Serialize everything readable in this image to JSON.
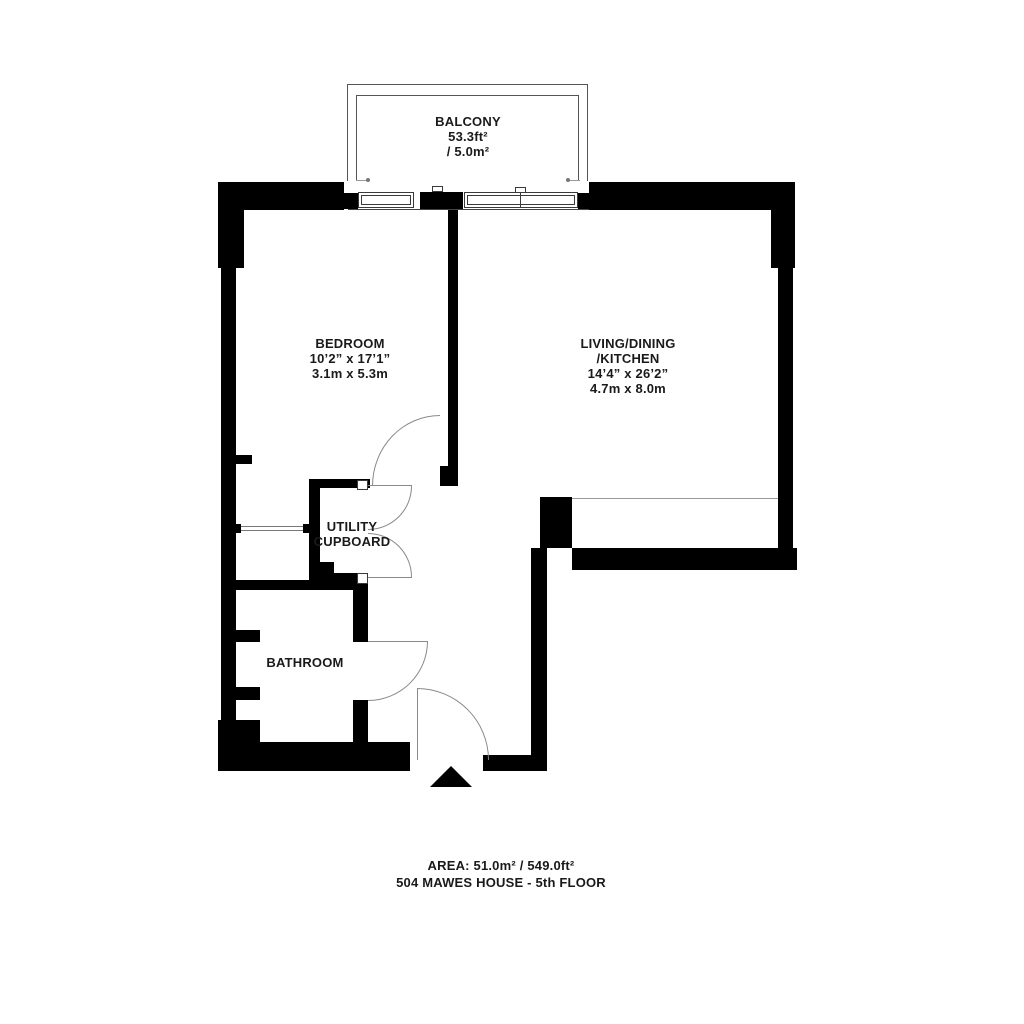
{
  "balcony": {
    "label": "BALCONY",
    "area_imperial": "53.3ft²",
    "area_metric": "/ 5.0m²"
  },
  "bedroom": {
    "label": "BEDROOM",
    "dims_imperial": "10’2” x 17’1”",
    "dims_metric": "3.1m x 5.3m"
  },
  "living": {
    "label_line1": "LIVING/DINING",
    "label_line2": "/KITCHEN",
    "dims_imperial": "14’4” x 26’2”",
    "dims_metric": "4.7m x 8.0m"
  },
  "utility": {
    "label_line1": "UTILITY",
    "label_line2": "CUPBOARD"
  },
  "bathroom": {
    "label": "BATHROOM"
  },
  "footer": {
    "area": "AREA: 51.0m² / 549.0ft²",
    "building": "504 MAWES HOUSE - 5th FLOOR"
  },
  "colors": {
    "wall": "#000000",
    "door_line": "#8a8a8a",
    "window_line": "#3a3a3a",
    "text": "#1a1a1a",
    "background": "#ffffff"
  }
}
